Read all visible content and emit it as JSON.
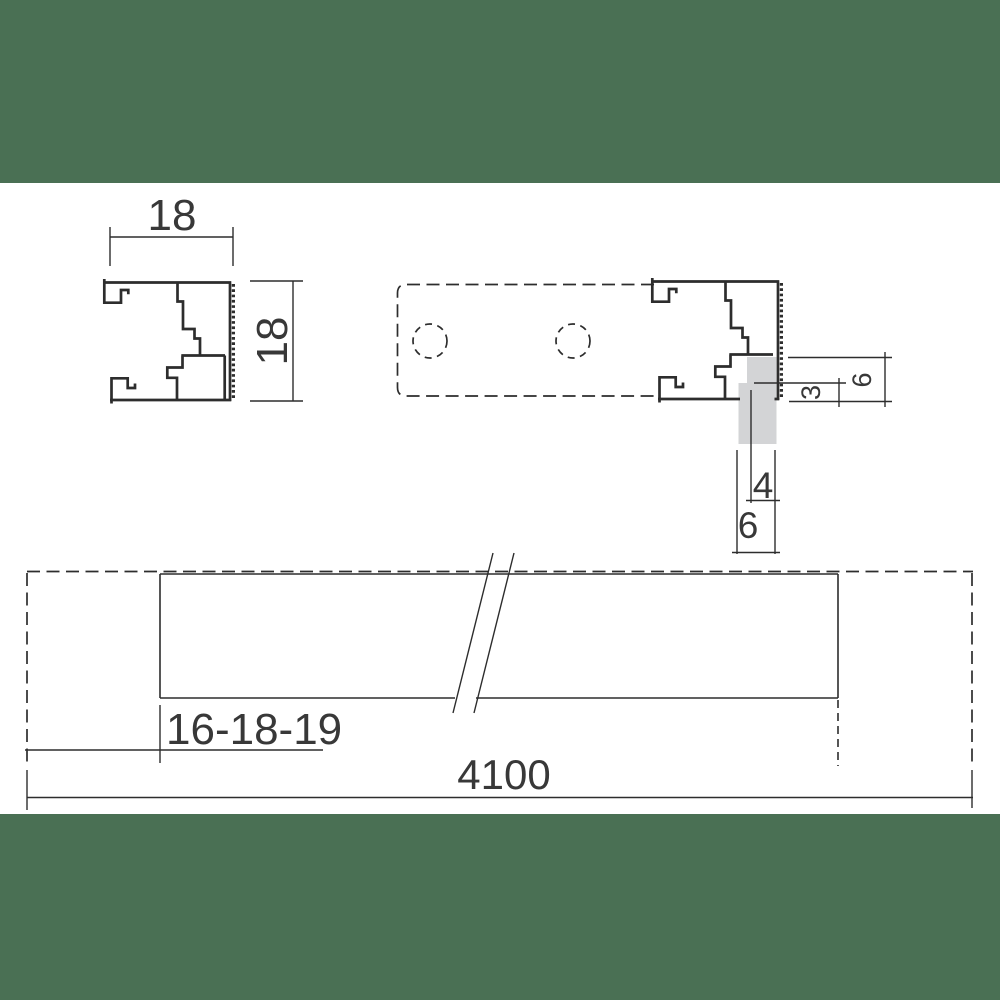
{
  "meta": {
    "type": "technical-drawing",
    "subject": "glazing-profile-cross-section-and-length"
  },
  "colors": {
    "band_green": "#4a7054",
    "line": "#2d2d2d",
    "text_color": "#383838",
    "panel_gray": "#d3d4d6",
    "background": "#ffffff"
  },
  "labels": {
    "profile_width": "18",
    "profile_height": "18",
    "rebate_height": "6",
    "edge_distance": "3",
    "panel_step_width": "4",
    "groove_width": "6",
    "panel_thickness_options": "16-18-19",
    "profile_length": "4100"
  }
}
